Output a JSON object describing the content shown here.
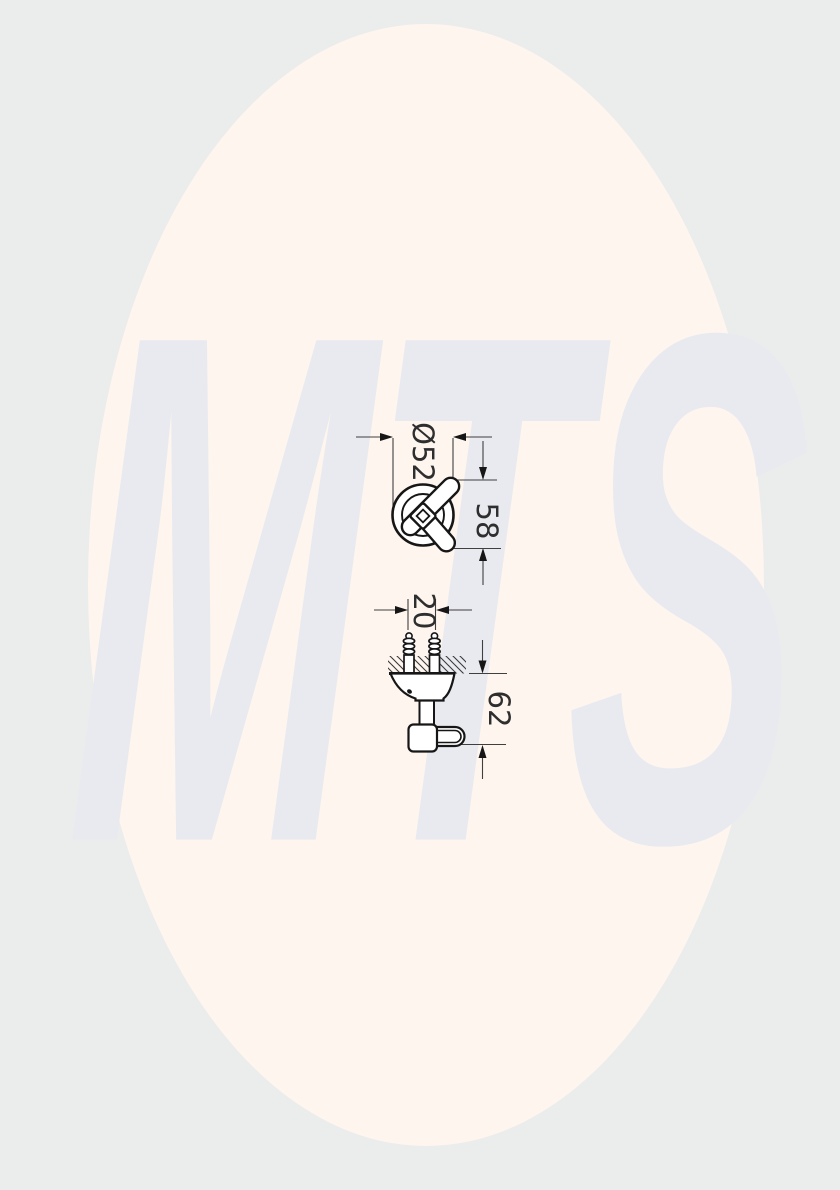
{
  "colors": {
    "background": "#ebecec",
    "oval": "#fdf5ee",
    "watermark_text": "#e8eaf0",
    "line": "#161616",
    "dim_line": "#3f3f3f"
  },
  "watermark": {
    "text": "MTS"
  },
  "drawing": {
    "front_view": {
      "diameter_label": "Ø52",
      "overall_height_label": "58"
    },
    "side_view": {
      "hole_spacing_label": "20",
      "projection_label": "62"
    }
  }
}
